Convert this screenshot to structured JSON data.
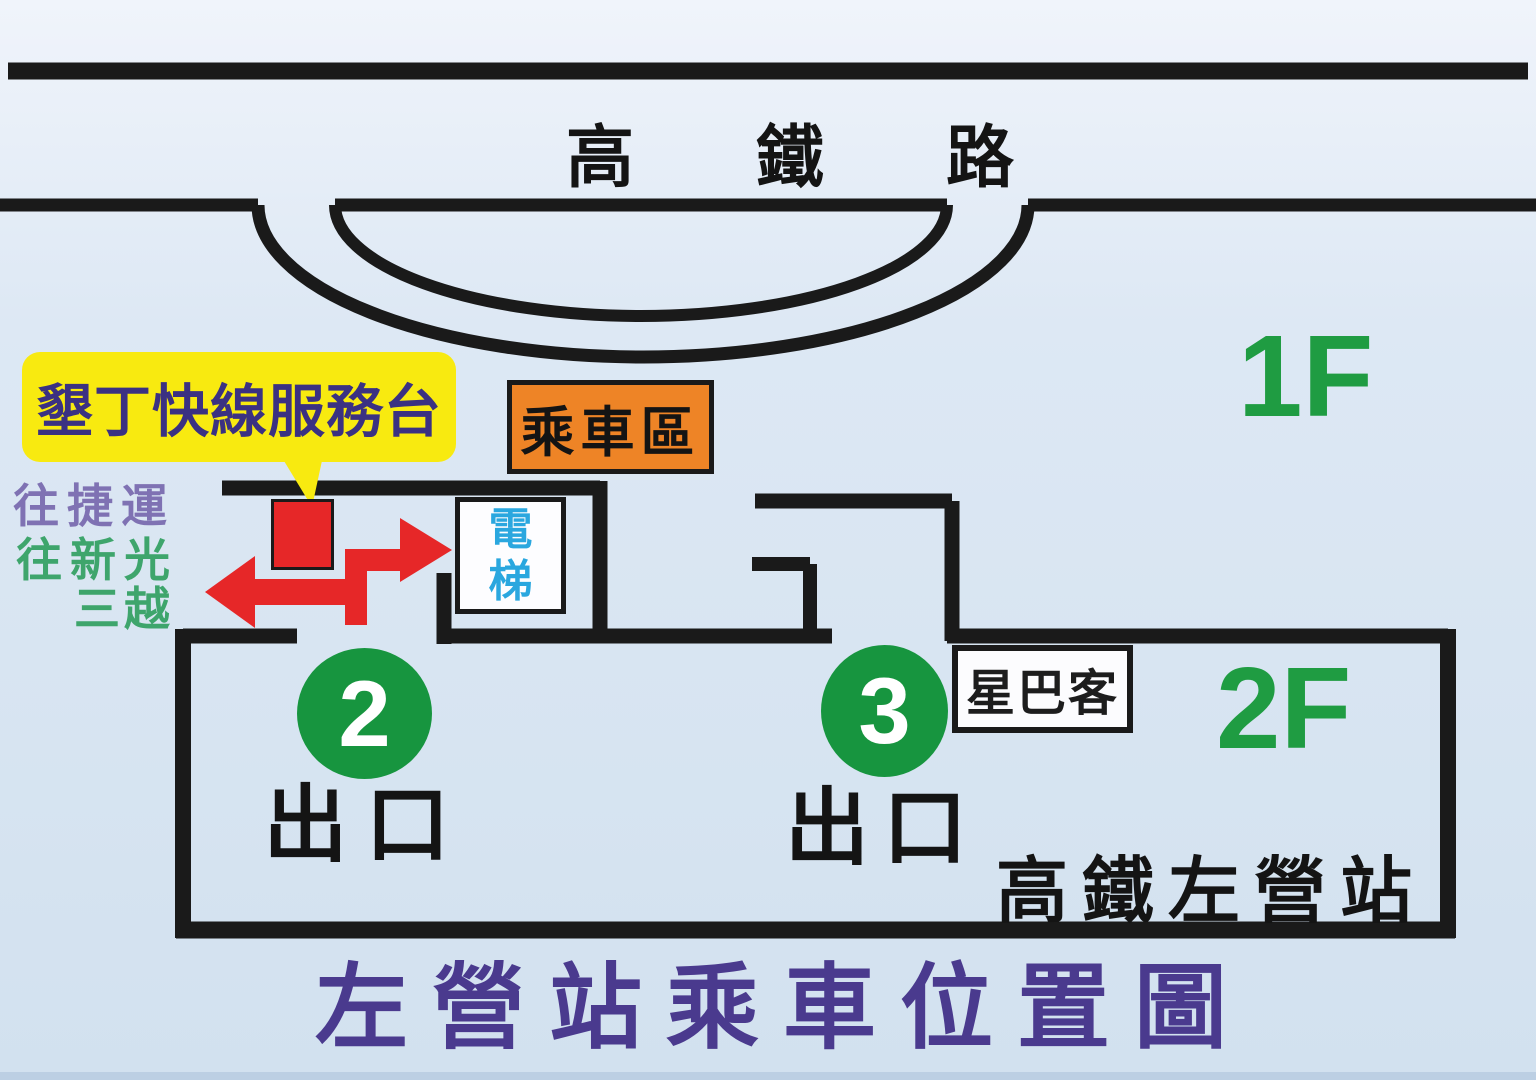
{
  "map": {
    "road_name": "高鐵路",
    "floor_1_label": "1F",
    "floor_2_label": "2F",
    "service_desk_label": "墾丁快線服務台",
    "boarding_area_label": "乘車區",
    "elevator_line1": "電",
    "elevator_line2": "梯",
    "direction_mrt": "往捷運",
    "direction_shinkong_line1": "往新光",
    "direction_shinkong_line2": "三越",
    "exit2_number": "2",
    "exit2_label": "出口",
    "exit3_number": "3",
    "exit3_label": "出口",
    "starbucks_label": "星巴客",
    "station_name": "高鐵左營站",
    "title": "左營站乘車位置圖"
  },
  "colors": {
    "bg_top": "#f0f4fb",
    "bg_mid": "#dde8f4",
    "bg_bottom": "#d2e1ef",
    "wall": "#1a1a1a",
    "black_text": "#141414",
    "yellow": "#f8ea10",
    "indigo": "#3b3182",
    "orange": "#ee8426",
    "red": "#e62728",
    "green_circle": "#17953f",
    "green_text": "#1f9c42",
    "purple_title": "#4a3a8e",
    "purple_mrt": "#7f72b3",
    "green_dir": "#3ea56c",
    "blue_elevator": "#2aa7df",
    "bottom_strip": "#bccfe3"
  }
}
